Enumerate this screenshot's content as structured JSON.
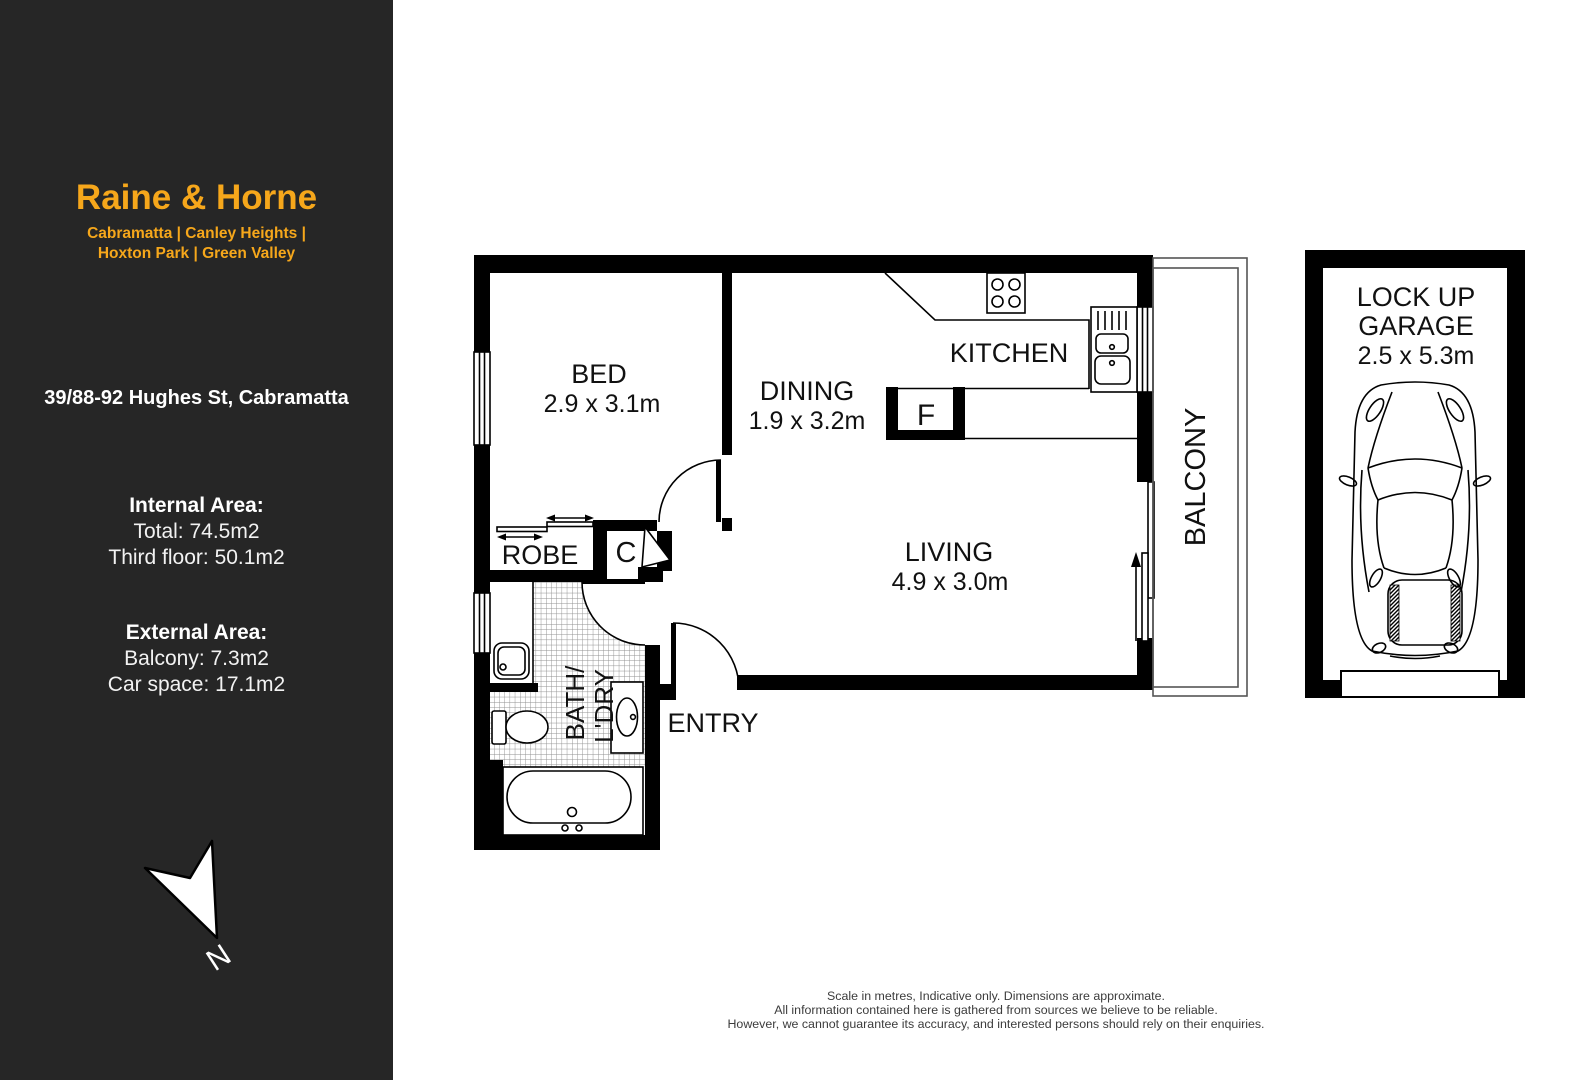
{
  "sidebar": {
    "brand": "Raine & Horne",
    "brand_line1": "Cabramatta | Canley Heights |",
    "brand_line2": "Hoxton Park | Green Valley",
    "address": "39/88-92 Hughes St, Cabramatta",
    "internal": {
      "heading": "Internal Area:",
      "total": "Total: 74.5m2",
      "floor": "Third floor: 50.1m2"
    },
    "external": {
      "heading": "External Area:",
      "balcony": "Balcony: 7.3m2",
      "car_space": "Car space: 17.1m2"
    },
    "north_label": "N",
    "colors": {
      "background": "#262626",
      "accent": "#F6A71B",
      "text": "#ffffff"
    }
  },
  "floorplan": {
    "rooms": {
      "bed": {
        "label": "BED",
        "dims": "2.9 x 3.1m"
      },
      "dining": {
        "label": "DINING",
        "dims": "1.9 x 3.2m"
      },
      "kitchen": {
        "label": "KITCHEN"
      },
      "living": {
        "label": "LIVING",
        "dims": "4.9 x 3.0m"
      },
      "balcony": {
        "label": "BALCONY"
      },
      "robe": {
        "label": "ROBE"
      },
      "closet": {
        "label": "C"
      },
      "fridge": {
        "label": "F"
      },
      "bath_line1": "BATH/",
      "bath_line2": "L'DRY",
      "entry": {
        "label": "ENTRY"
      },
      "garage": {
        "line1": "LOCK UP",
        "line2": "GARAGE",
        "dims": "2.5 x 5.3m"
      }
    },
    "colors": {
      "walls": "#000000",
      "tile_grid": "#8f8f8f"
    },
    "disclaimer": {
      "line1": "Scale in metres, Indicative only. Dimensions are approximate.",
      "line2": "All information contained here is gathered from sources we believe to be reliable.",
      "line3": "However,  we cannot guarantee its accuracy, and interested persons should rely on their enquiries."
    }
  }
}
